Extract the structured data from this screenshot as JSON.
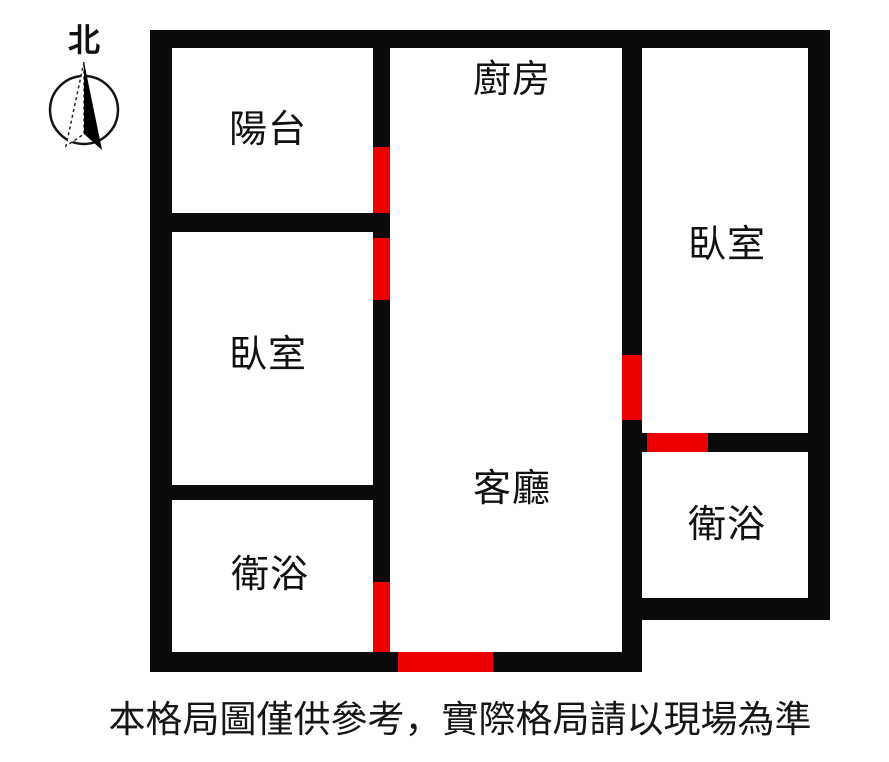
{
  "compass": {
    "label": "北"
  },
  "disclaimer": "本格局圖僅供參考，實際格局請以現場為準",
  "colors": {
    "wall": "#0b0b0b",
    "door": "#ee0000",
    "background": "#ffffff",
    "text": "#111111"
  },
  "rooms": [
    {
      "id": "balcony",
      "label": "陽台",
      "cx": 268,
      "cy": 130
    },
    {
      "id": "kitchen",
      "label": "廚房",
      "cx": 512,
      "cy": 80
    },
    {
      "id": "bedroom-left",
      "label": "臥室",
      "cx": 268,
      "cy": 355
    },
    {
      "id": "bedroom-right",
      "label": "臥室",
      "cx": 727,
      "cy": 245
    },
    {
      "id": "living-room",
      "label": "客廳",
      "cx": 512,
      "cy": 489
    },
    {
      "id": "bathroom-left",
      "label": "衛浴",
      "cx": 270,
      "cy": 575
    },
    {
      "id": "bathroom-right",
      "label": "衛浴",
      "cx": 727,
      "cy": 525
    }
  ],
  "floorplan": {
    "walls": [
      {
        "id": "outer-top",
        "x": 150,
        "y": 30,
        "w": 680,
        "h": 18
      },
      {
        "id": "outer-left",
        "x": 150,
        "y": 30,
        "w": 22,
        "h": 642
      },
      {
        "id": "outer-right",
        "x": 808,
        "y": 30,
        "w": 22,
        "h": 590
      },
      {
        "id": "bottom-main",
        "x": 150,
        "y": 652,
        "w": 492,
        "h": 20
      },
      {
        "id": "divider-balcony-bedroom",
        "x": 150,
        "y": 213,
        "w": 240,
        "h": 19
      },
      {
        "id": "divider-bedroom-bath-left",
        "x": 150,
        "y": 485,
        "w": 240,
        "h": 15
      },
      {
        "id": "wall-center-left",
        "x": 373,
        "y": 48,
        "w": 17,
        "h": 604
      },
      {
        "id": "wall-center-right",
        "x": 622,
        "y": 48,
        "w": 20,
        "h": 604
      },
      {
        "id": "divider-bedroom-bath-right",
        "x": 642,
        "y": 433,
        "w": 166,
        "h": 19
      },
      {
        "id": "bath-right-bottom",
        "x": 622,
        "y": 598,
        "w": 208,
        "h": 22
      }
    ],
    "doors": [
      {
        "id": "door-balcony",
        "x": 373,
        "y": 147,
        "w": 17,
        "h": 66
      },
      {
        "id": "door-bedroom-left",
        "x": 373,
        "y": 238,
        "w": 17,
        "h": 62
      },
      {
        "id": "door-bathroom-left",
        "x": 373,
        "y": 582,
        "w": 17,
        "h": 70
      },
      {
        "id": "door-entrance",
        "x": 398,
        "y": 652,
        "w": 95,
        "h": 20
      },
      {
        "id": "door-bedroom-right",
        "x": 622,
        "y": 355,
        "w": 20,
        "h": 65
      },
      {
        "id": "door-bathroom-right",
        "x": 647,
        "y": 433,
        "w": 61,
        "h": 19
      }
    ]
  }
}
